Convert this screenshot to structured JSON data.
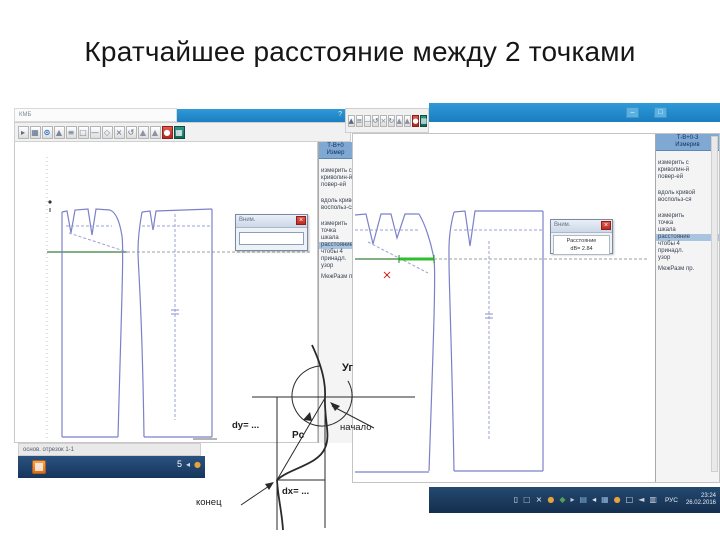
{
  "slide": {
    "title": "Кратчайшее расстояние между 2 точками"
  },
  "colors": {
    "titlebar_blue": "#1e86c6",
    "taskbar_navy": "#1b3a5e",
    "pattern_blue": "#7b81c9",
    "hip_green": "#3a7d3a",
    "measure_green": "#2fbf2f",
    "alert_red": "#c9302c",
    "sidebar_highlight": "#a8c4e0"
  },
  "win1": {
    "menu_text": "КМБ",
    "titlebar_hint": "?",
    "toolbar": [
      {
        "g": "▸",
        "s": "color:#5a6b85"
      },
      {
        "g": "▦",
        "s": "color:#5a6b85"
      },
      {
        "g": "⊙",
        "s": "color:#1565c0;font-weight:bold"
      },
      {
        "g": "▲",
        "s": "color:#7a8699"
      },
      {
        "g": "≡",
        "s": "color:#5a6b85"
      },
      {
        "g": "□",
        "s": "color:#7a8699"
      },
      {
        "g": "—",
        "s": "color:#5a6b85"
      },
      {
        "g": "◇",
        "s": "color:#7a8699"
      },
      {
        "g": "×",
        "s": "color:#5a6b85"
      },
      {
        "g": "↺",
        "s": "color:#5a6b85"
      },
      {
        "g": "▲",
        "s": "color:#8a93a5"
      },
      {
        "g": "▲",
        "s": "color:#8a93a5"
      },
      {
        "g": "●",
        "s": "background:linear-gradient(#e05a50,#b02920);color:#fff;border-color:#8a1f1c"
      },
      {
        "g": "▦",
        "s": "background:linear-gradient(#2a9a88,#13655a);color:#fff;border-color:#0e4a42"
      }
    ],
    "sidebar": {
      "header1": "Т-В+0",
      "header2": "Измер",
      "block1": [
        "измерить с",
        "криволин-й",
        "повер-ей"
      ],
      "block2": [
        "вдоль кривой",
        "воспольз-ся"
      ],
      "block3a": [
        "измерить",
        "точка",
        "шкала"
      ],
      "highlight": "расстояние",
      "block3b": [
        "чтобы 4",
        "принадл.",
        "узор"
      ],
      "footer": "МежРазм пр."
    },
    "dialog": {
      "title": "Вним.",
      "close": "×"
    },
    "status": "основ. отрезок 1-1",
    "taskbar": {
      "badge": "5",
      "icons": [
        {
          "g": "◂",
          "s": "color:#cfd8e4"
        },
        {
          "g": "●",
          "s": "color:#e8a23c"
        }
      ]
    }
  },
  "win2": {
    "toolbar": [
      {
        "g": "▲",
        "s": "color:#5a6b85"
      },
      {
        "g": "≡",
        "s": "color:#5a6b85"
      },
      {
        "g": "—",
        "s": "color:#7a8699"
      },
      {
        "g": "↺",
        "s": "color:#5a6b85"
      },
      {
        "g": "×",
        "s": "color:#7a8699"
      },
      {
        "g": "↻",
        "s": "color:#5a6b85"
      },
      {
        "g": "▲",
        "s": "color:#8a93a5"
      },
      {
        "g": "▲",
        "s": "color:#8a93a5"
      },
      {
        "g": "●",
        "s": "background:linear-gradient(#e05a50,#b02920);color:#fff;border-color:#8a1f1c"
      },
      {
        "g": "▦",
        "s": "background:linear-gradient(#2a9a88,#13655a);color:#fff;border-color:#0e4a42"
      }
    ],
    "titlebar": {
      "minimize": "–",
      "maximize": "□"
    },
    "sidebar": {
      "header1": "Т-В+0-3",
      "header2": "Измерив",
      "block1": [
        "измерить с",
        "криволин-й",
        "повер-ей"
      ],
      "block2": [
        "вдоль кривой",
        "воспольз-ся"
      ],
      "block3a": [
        "измерить",
        "точка",
        "шкала"
      ],
      "highlight": "расстояние",
      "block3b": [
        "чтобы 4",
        "принадл.",
        "узор"
      ],
      "footer": "МежРазм пр."
    },
    "dialog": {
      "title": "Вним.",
      "close": "×",
      "line1": "Расстояние",
      "line2": "dВ= 2.84"
    },
    "taskbar": {
      "icons": [
        {
          "g": "▯",
          "s": "color:#d8dee8"
        },
        {
          "g": "□",
          "s": "color:#aab4c0"
        },
        {
          "g": "×",
          "s": "color:#e8ecf2"
        },
        {
          "g": "●",
          "s": "color:#e8a23c"
        },
        {
          "g": "◆",
          "s": "color:#58a058"
        },
        {
          "g": "▸",
          "s": "color:#c8d0dc"
        },
        {
          "g": "▤",
          "s": "color:#82aed2"
        },
        {
          "g": "◂",
          "s": "color:#e0e6ee"
        },
        {
          "g": "▦",
          "s": "color:#8fb6da"
        },
        {
          "g": "●",
          "s": "color:#e8a23c"
        },
        {
          "g": "□",
          "s": "color:#d8dee8"
        },
        {
          "g": "◄",
          "s": "color:#c8d0dc"
        },
        {
          "g": "▥",
          "s": "color:#d0d8e2"
        }
      ],
      "lang": "РУС",
      "time": "23:24",
      "date": "26.02.2016"
    }
  },
  "diagram": {
    "angle_label": "Уг",
    "start_label": "начало",
    "end_label": "конец",
    "dy_label": "dy= ...",
    "dx_label": "dx= ...",
    "chord_label": "Рс"
  }
}
